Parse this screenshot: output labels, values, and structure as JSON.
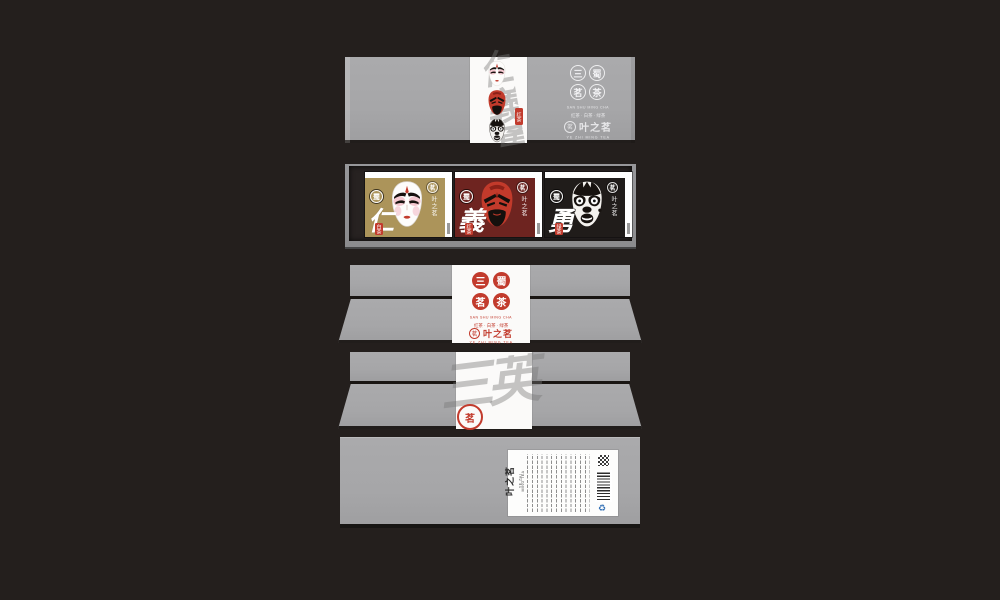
{
  "colors": {
    "page-bg": "#241f1d",
    "box-gray": "#a6a6a8",
    "band-white": "#fbfaf9",
    "tray-dark": "#272221",
    "seal-red": "#c23b2d",
    "gold-card": "#ac945a",
    "maroon-card": "#6e2420",
    "mask-red": "#c23a2b",
    "black-card": "#201c1a",
    "ink": "#17120f"
  },
  "brand": {
    "name": "叶之茗",
    "romanized": "YE ZHI MING TEA",
    "pinyin": "SAN SHU MING CHA",
    "product_line": "红茶 · 白茶 · 绿茶",
    "seal_chars": [
      "三",
      "蜀",
      "茗",
      "茶"
    ],
    "logo_glyph": "茗"
  },
  "lid": {
    "watermark": "仁義勇",
    "tag": "红茶"
  },
  "tray": {
    "cards": [
      {
        "virtue": "仁",
        "tag": "白茶"
      },
      {
        "virtue": "義",
        "tag": "红茶"
      },
      {
        "virtue": "勇",
        "tag": "绿茶"
      }
    ]
  },
  "back": {
    "watermark": "三英",
    "seal_glyph": "茗"
  }
}
